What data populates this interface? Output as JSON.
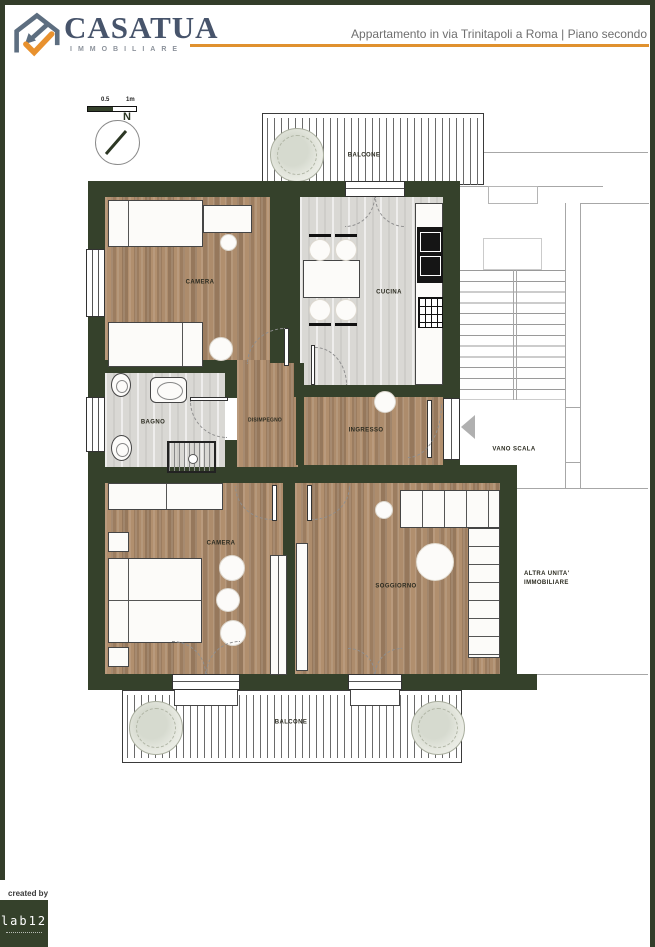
{
  "header": {
    "brand": "CASATUA",
    "brand_sub": "IMMOBILIARE",
    "title": "Appartamento in via Trinitapoli a Roma | Piano secondo",
    "accent_color": "#e0912e",
    "brand_color": "#47546b"
  },
  "tools": {
    "scale_mid": "0.5",
    "scale_end": "1m",
    "compass_north": "N"
  },
  "plan": {
    "colors": {
      "wall": "#35412b",
      "wood_floor": "#a8866a",
      "tile_floor": "#d9d8d4"
    },
    "rooms": {
      "balcone_top": {
        "label": "BALCONE"
      },
      "camera_top": {
        "label": "CAMERA"
      },
      "cucina": {
        "label": "CUCINA"
      },
      "bagno": {
        "label": "BAGNO"
      },
      "disimpegno": {
        "label": "DISIMPEGNO"
      },
      "ingresso": {
        "label": "INGRESSO"
      },
      "vano_scala": {
        "label": "VANO SCALA"
      },
      "camera_bottom": {
        "label": "CAMERA"
      },
      "soggiorno": {
        "label": "SOGGIORNO"
      },
      "balcone_bottom": {
        "label": "BALCONE"
      },
      "altra_unita": {
        "line1": "ALTRA UNITA'",
        "line2": "IMMOBILIARE"
      }
    }
  },
  "footer": {
    "created_by": "created by",
    "studio": "lab12"
  }
}
